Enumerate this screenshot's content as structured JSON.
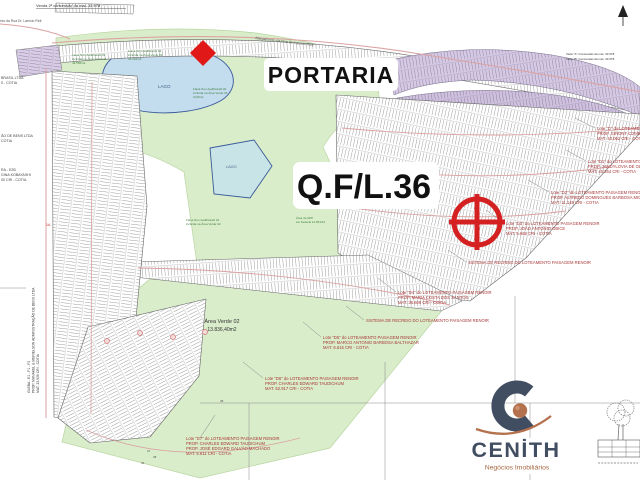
{
  "map": {
    "labels": {
      "portaria": "PORTARIA",
      "qfl": "Q.F/L.36",
      "lago_upper": "LAGO",
      "lago_lower": "LAGO",
      "area_verde_1": "Área Verde 02",
      "area_verde_2": "13.836,40m2",
      "top_note": "Venda 2ª concessão da mat. 33.978",
      "road_label_1": "Alargamento da Rua Dr. Laercio Reti",
      "road_label_2": "Alargamento da Rua Dr. Laercio Reti",
      "viela_1": "Viela \"A\" Concessão da mat. 33.978",
      "viela_2": "Viela \"B\" Concessão da mat. 33.978",
      "marker_1a": "1A"
    },
    "numbers": [
      "36",
      "37",
      "38",
      "38"
    ],
    "left_annotations": [
      {
        "lines": [
          "BRASIL LTDA",
          "0 - COTIA"
        ]
      },
      {
        "lines": [
          "ÃO DE BENS LTDA",
          "COTIA"
        ]
      },
      {
        "lines": [
          "RA - E2B",
          "GINA KOBAYASHI",
          "00 CRI - COTIA"
        ]
      }
    ],
    "vertical_annotation": {
      "lines": [
        "GLEBA - E1 - F1 - F2",
        "PROP. MANAKEL & MERIELSON ADMINISTRAÇÃO DE BENS LTDA",
        "MAT. 33.936 CRI - COTIA"
      ]
    },
    "right_annotations": [
      {
        "lines": [
          "Lote \"D\" do LOTEAMENTO PAISAGEM RENOIR",
          "PROP. GIRONT COMERCIAL",
          "MAT. 40.062 CRI - COTIA"
        ]
      },
      {
        "lines": [
          "Lote \"D1\" do LOTEAMENTO PAISAGEM RENOIR",
          "PROP. JANDYLOVIA DE OLIVEIRA",
          "MAT. 40.264 CRI - COTIA"
        ]
      },
      {
        "lines": [
          "Lote \"D2\" do LOTEAMENTO PAISAGEM RENOIR",
          "PROP. ALFREDO DOMINGUES BARBOSA MIGUEL",
          "MAT. 11.149 CRI - COTIA"
        ]
      },
      {
        "lines": [
          "Lote \"D3\" do LOTEAMENTO PAISAGEM RENOIR",
          "PROP. JOÃO ANTONIO OBICE",
          "MAT. 5.968 CRI - COTIA"
        ]
      },
      {
        "lines": [
          "SISTEMA DE RECREIO DO LOTEAMENTO PAISAGEM RENOIR"
        ]
      },
      {
        "lines": [
          "Lote \"D4\" do LOTEAMENTO PAISAGEM RENOIR",
          "PROP. MARIA COSTA DOS SANTOS",
          "MAT. 36.609 CRI - COTIA"
        ]
      },
      {
        "lines": [
          "SISTEMA DE RECREIO DO LOTEAMENTO PAISAGEM RENOIR"
        ]
      },
      {
        "lines": [
          "Lote \"D5\" do LOTEAMENTO PAISAGEM RENOIR",
          "PROP. MARCO ANTONIO BARBOSA BALTHAZAR",
          "MAT. 6.615 CRI - COTIA"
        ]
      },
      {
        "lines": [
          "Lote \"D6\" do LOTEAMENTO PAISAGEM RENOIR",
          "PROP. CHARLES EDWARD TAUDICHUM",
          "MAT. 52.917 CRI - COTIA"
        ]
      },
      {
        "lines": [
          "Lote \"D7\" do LOTEAMENTO PAISAGEM RENOIR",
          "PROP. CHARLES EDWARD TAUDICHUM",
          "PROP. JOSÉ EDGARD GALVÃO MACHADO",
          "MAT. 5.611 CRI - COTIA"
        ]
      }
    ],
    "green_notes": [
      {
        "lines": [
          "Faixa Non Aedificandi 03",
          "incluída na Área Verde 01",
          "43.556m2"
        ]
      },
      {
        "lines": [
          "Faixa Non Aedificandi 03",
          "incluída na Área Verde 01",
          "45.004m2"
        ]
      },
      {
        "lines": [
          "Faixa Non Aedificandi 02",
          "incluída na Área Verde 01",
          "(3,00m)"
        ]
      },
      {
        "lines": [
          "Faixa Non Aedificandi 01",
          "incluída na Área Verde 02"
        ]
      },
      {
        "lines": [
          "Área de APP",
          "Lei Federal 12.651/12"
        ]
      }
    ]
  },
  "logo": {
    "name": "CENİTH",
    "tagline": "Negócios Imobiliários"
  },
  "colors": {
    "brand": "#414d61",
    "accent": "#b4714d",
    "green_area": "#d9edca",
    "lake": "#c3dcee",
    "lavender": "#d6c9e6",
    "road_pink": "#dba3a3",
    "marker_red": "#d42020",
    "annotation_red": "#a83838"
  }
}
